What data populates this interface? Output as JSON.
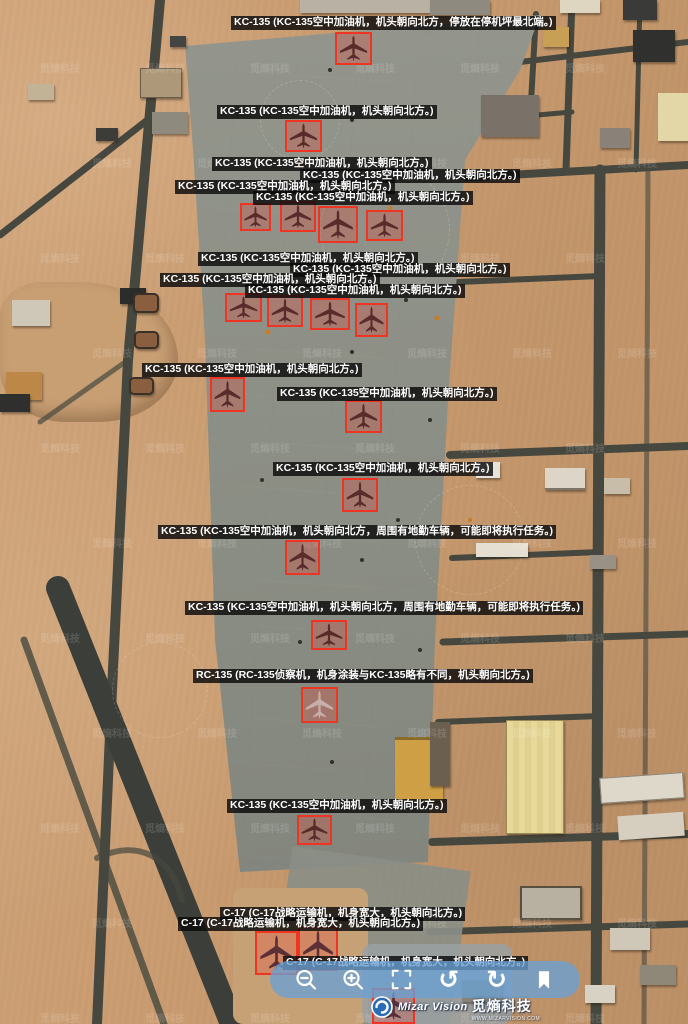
{
  "app": {
    "name": "Mizar Vision",
    "brand_cn": "觅熵科技",
    "website": "WWW.MIZARVISION.COM"
  },
  "watermark": {
    "text": "觅熵科技"
  },
  "colors": {
    "annotation_box_border": "#ee3524",
    "annotation_box_fill": "rgba(240,60,45,0.26)",
    "label_background": "rgba(10,10,10,0.82)",
    "label_text": "#ffffff",
    "toolbar_background": "rgba(106,160,212,0.78)",
    "toolbar_icon": "#ffffff",
    "aircraft_kc135": "#4d2121",
    "aircraft_rc135": "#cdb6b0",
    "aircraft_c17": "#4a2430"
  },
  "annotations": {
    "labels": [
      {
        "text": "KC-135 (KC-135空中加油机，机头朝向北方，停放在停机坪最北端。)",
        "x": 231,
        "y": 16
      },
      {
        "text": "KC-135 (KC-135空中加油机，机头朝向北方。)",
        "x": 217,
        "y": 105
      },
      {
        "text": "KC-135 (KC-135空中加油机，机头朝向北方。)",
        "x": 212,
        "y": 157
      },
      {
        "text": "KC-135 (KC-135空中加油机，机头朝向北方。)",
        "x": 300,
        "y": 169
      },
      {
        "text": "KC-135 (KC-135空中加油机，机头朝向北方。)",
        "x": 175,
        "y": 180
      },
      {
        "text": "KC-135 (KC-135空中加油机，机头朝向北方。)",
        "x": 253,
        "y": 191
      },
      {
        "text": "KC-135 (KC-135空中加油机，机头朝向北方。)",
        "x": 198,
        "y": 252
      },
      {
        "text": "KC-135 (KC-135空中加油机，机头朝向北方。)",
        "x": 290,
        "y": 263
      },
      {
        "text": "KC-135 (KC-135空中加油机，机头朝向北方。)",
        "x": 160,
        "y": 273
      },
      {
        "text": "KC-135 (KC-135空中加油机，机头朝向北方。)",
        "x": 245,
        "y": 284
      },
      {
        "text": "KC-135 (KC-135空中加油机，机头朝向北方。)",
        "x": 142,
        "y": 363
      },
      {
        "text": "KC-135 (KC-135空中加油机，机头朝向北方。)",
        "x": 277,
        "y": 387
      },
      {
        "text": "KC-135 (KC-135空中加油机，机头朝向北方。)",
        "x": 273,
        "y": 462
      },
      {
        "text": "KC-135 (KC-135空中加油机，机头朝向北方，周围有地勤车辆，可能即将执行任务。)",
        "x": 158,
        "y": 525
      },
      {
        "text": "KC-135 (KC-135空中加油机，机头朝向北方，周围有地勤车辆，可能即将执行任务。)",
        "x": 185,
        "y": 601
      },
      {
        "text": "RC-135 (RC-135侦察机，机身涂装与KC-135略有不同，机头朝向北方。)",
        "x": 193,
        "y": 669
      },
      {
        "text": "KC-135 (KC-135空中加油机，机头朝向北方。)",
        "x": 227,
        "y": 799
      },
      {
        "text": "C-17 (C-17战略运输机，机身宽大，机头朝向北方。)",
        "x": 220,
        "y": 907
      },
      {
        "text": "C-17 (C-17战略运输机，机身宽大，机头朝向北方。)",
        "x": 178,
        "y": 917
      },
      {
        "text": "C-17 (C-17战略运输机，机身宽大，机头朝向北方。)",
        "x": 283,
        "y": 956
      }
    ],
    "boxes": [
      {
        "x": 335,
        "y": 32,
        "w": 37,
        "h": 33,
        "type": "kc135"
      },
      {
        "x": 285,
        "y": 120,
        "w": 37,
        "h": 32,
        "type": "kc135"
      },
      {
        "x": 240,
        "y": 203,
        "w": 31,
        "h": 28,
        "type": "kc135"
      },
      {
        "x": 280,
        "y": 201,
        "w": 36,
        "h": 31,
        "type": "kc135"
      },
      {
        "x": 318,
        "y": 206,
        "w": 40,
        "h": 37,
        "type": "kc135"
      },
      {
        "x": 366,
        "y": 210,
        "w": 37,
        "h": 31,
        "type": "kc135"
      },
      {
        "x": 225,
        "y": 293,
        "w": 37,
        "h": 29,
        "type": "kc135"
      },
      {
        "x": 267,
        "y": 295,
        "w": 36,
        "h": 32,
        "type": "kc135"
      },
      {
        "x": 310,
        "y": 298,
        "w": 40,
        "h": 32,
        "type": "kc135"
      },
      {
        "x": 355,
        "y": 303,
        "w": 33,
        "h": 34,
        "type": "kc135"
      },
      {
        "x": 210,
        "y": 377,
        "w": 35,
        "h": 35,
        "type": "kc135"
      },
      {
        "x": 345,
        "y": 400,
        "w": 37,
        "h": 33,
        "type": "kc135"
      },
      {
        "x": 342,
        "y": 478,
        "w": 36,
        "h": 34,
        "type": "kc135"
      },
      {
        "x": 285,
        "y": 540,
        "w": 35,
        "h": 35,
        "type": "kc135"
      },
      {
        "x": 311,
        "y": 620,
        "w": 36,
        "h": 30,
        "type": "kc135"
      },
      {
        "x": 301,
        "y": 687,
        "w": 37,
        "h": 36,
        "type": "rc135"
      },
      {
        "x": 297,
        "y": 815,
        "w": 35,
        "h": 30,
        "type": "kc135"
      },
      {
        "x": 255,
        "y": 931,
        "w": 43,
        "h": 44,
        "type": "c17"
      },
      {
        "x": 298,
        "y": 926,
        "w": 40,
        "h": 45,
        "type": "c17"
      },
      {
        "x": 372,
        "y": 988,
        "w": 43,
        "h": 36,
        "type": "c17"
      }
    ]
  },
  "toolbar": {
    "buttons": [
      {
        "name": "zoom-out"
      },
      {
        "name": "zoom-in"
      },
      {
        "name": "fit-view"
      },
      {
        "name": "rotate-ccw"
      },
      {
        "name": "rotate-cw"
      },
      {
        "name": "bookmark"
      }
    ]
  }
}
